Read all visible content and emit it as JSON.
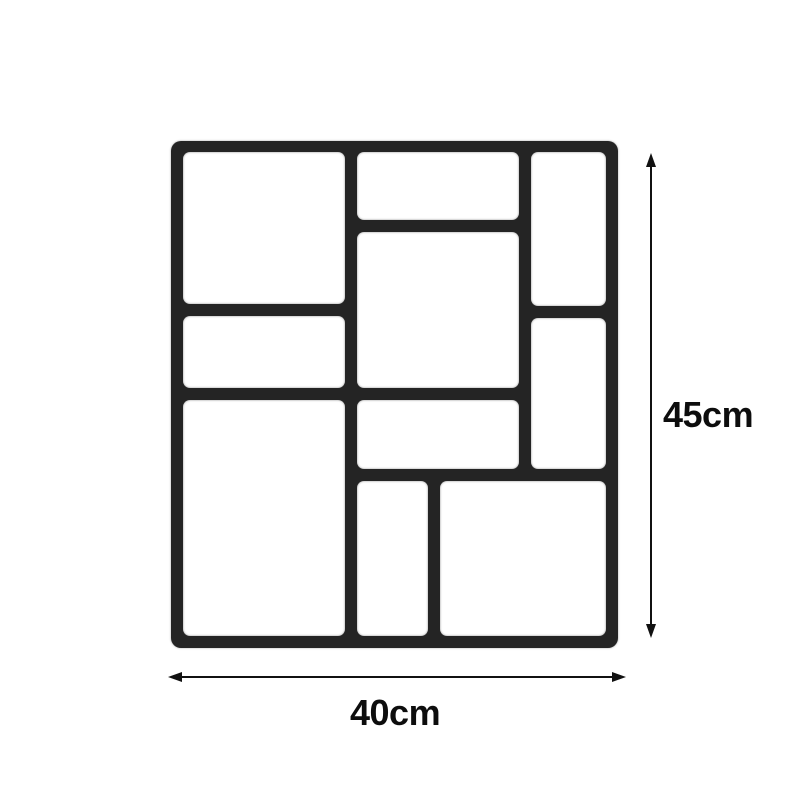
{
  "figure": {
    "kind": "product-dimension-diagram",
    "subject": "paving mold grid (10 cavities)",
    "background_color": "#ffffff"
  },
  "dimensions": {
    "height_label": "45cm",
    "width_label": "40cm",
    "arrow_color": "#111111",
    "label_color": "#0d0d0d"
  },
  "mold": {
    "frame_color": "#242424",
    "cavity_color": "#ffffff",
    "frame": {
      "x": 171,
      "y": 141,
      "w": 447,
      "h": 507
    },
    "cavities": [
      {
        "name": "cavity-left-top",
        "x": 12,
        "y": 11,
        "w": 162,
        "h": 152
      },
      {
        "name": "cavity-left-middle",
        "x": 12,
        "y": 175,
        "w": 162,
        "h": 72
      },
      {
        "name": "cavity-left-bottom",
        "x": 12,
        "y": 259,
        "w": 162,
        "h": 236
      },
      {
        "name": "cavity-center-top",
        "x": 186,
        "y": 11,
        "w": 162,
        "h": 68
      },
      {
        "name": "cavity-center-main",
        "x": 186,
        "y": 91,
        "w": 162,
        "h": 156
      },
      {
        "name": "cavity-center-lower",
        "x": 186,
        "y": 259,
        "w": 162,
        "h": 69
      },
      {
        "name": "cavity-right-top",
        "x": 360,
        "y": 11,
        "w": 75,
        "h": 154
      },
      {
        "name": "cavity-right-middle",
        "x": 360,
        "y": 177,
        "w": 75,
        "h": 151
      },
      {
        "name": "cavity-bottom-narrow",
        "x": 186,
        "y": 340,
        "w": 71,
        "h": 155
      },
      {
        "name": "cavity-bottom-wide",
        "x": 269,
        "y": 340,
        "w": 166,
        "h": 155
      }
    ]
  },
  "height_arrow": {
    "x": 650,
    "top_tip": 153,
    "bottom_tip": 638
  },
  "width_arrow": {
    "y": 676,
    "left_tip": 168,
    "right_tip": 626
  }
}
